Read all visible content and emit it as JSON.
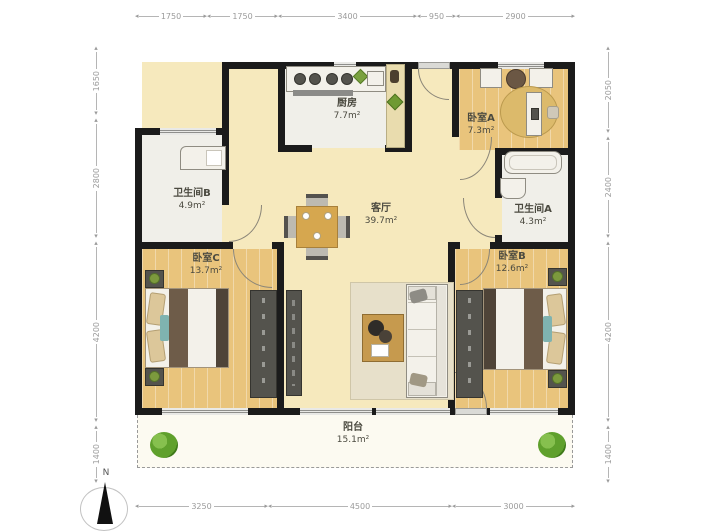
{
  "dimensions": {
    "top": [
      "1750",
      "1750",
      "3400",
      "950",
      "2900"
    ],
    "bottom": [
      "3250",
      "4500",
      "3000"
    ],
    "left": [
      "1650",
      "2800",
      "4200",
      "1400"
    ],
    "right": [
      "2050",
      "2400",
      "4200",
      "1400"
    ]
  },
  "rooms": {
    "kitchen": {
      "name": "厨房",
      "area": "7.7m²"
    },
    "bedroom_a": {
      "name": "卧室A",
      "area": "7.3m²"
    },
    "bathroom_a": {
      "name": "卫生间A",
      "area": "4.3m²"
    },
    "bathroom_b": {
      "name": "卫生间B",
      "area": "4.9m²"
    },
    "living": {
      "name": "客厅",
      "area": "39.7m²"
    },
    "bedroom_c": {
      "name": "卧室C",
      "area": "13.7m²"
    },
    "bedroom_b": {
      "name": "卧室B",
      "area": "12.6m²"
    },
    "balcony": {
      "name": "阳台",
      "area": "15.1m²"
    }
  },
  "compass": {
    "label": "N"
  },
  "colors": {
    "wall": "#1b1b1b",
    "living_floor": "#f6e9bd",
    "wood_floor": "#e9c47c",
    "tile_floor": "#f0efe9",
    "balcony_floor": "#fcfaf1",
    "plant_green": "#5fa02c",
    "dimension_text": "#9b9b9b"
  }
}
